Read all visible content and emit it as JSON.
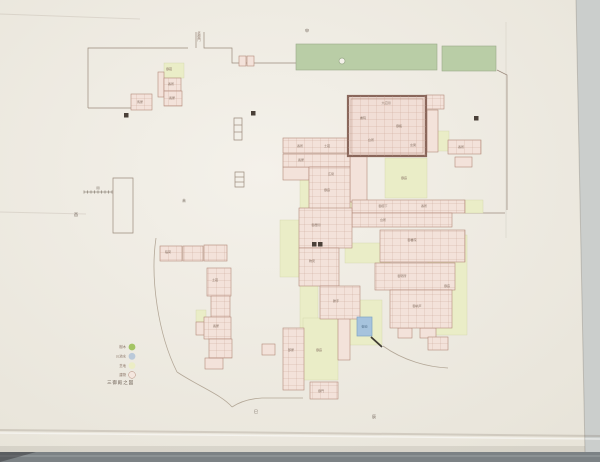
{
  "scene": {
    "table_color": "#b7babb",
    "table_right_color": "#cbcecc",
    "table_bottom_color": "#7c8285",
    "paper_light": "#f4f1ea",
    "paper_dark": "#e7e3d8"
  },
  "map": {
    "colors": {
      "ink": "#9b8a7c",
      "road": "#b3a797",
      "greenbelt": "#b9cda6",
      "greenbelt_stroke": "#99aa89",
      "courtyard": "#eaedc7",
      "courtyard_stroke": "#d2d5aa",
      "building_fill": "#f3e2da",
      "building_stroke": "#b28a7a",
      "room_line": "#c7a193",
      "main_fill": "#f1ded6",
      "main_stroke": "#8a675b",
      "water": "#a6c3dd",
      "water_stroke": "#7fa3c4",
      "gate_black": "#4a4038",
      "label_ink": "#8a7466",
      "mark_ink": "#6f6257"
    },
    "greenbelts": [
      [
        296,
        44,
        141,
        26
      ],
      [
        442,
        46,
        54,
        25
      ]
    ],
    "greenbelt_marker": {
      "cx": 342,
      "cy": 61,
      "r": 3
    },
    "courtyards": [
      [
        300,
        157,
        60,
        63
      ],
      [
        385,
        158,
        42,
        40
      ],
      [
        432,
        131,
        17,
        20
      ],
      [
        280,
        220,
        38,
        57
      ],
      [
        300,
        277,
        18,
        80
      ],
      [
        303,
        318,
        35,
        62
      ],
      [
        428,
        235,
        39,
        100
      ],
      [
        340,
        300,
        42,
        45
      ],
      [
        164,
        63,
        20,
        15
      ],
      [
        463,
        200,
        20,
        13
      ],
      [
        196,
        310,
        10,
        12
      ],
      [
        345,
        243,
        45,
        20
      ]
    ],
    "buildings_grid": [
      [
        164,
        78,
        17,
        13
      ],
      [
        164,
        91,
        18,
        15
      ],
      [
        131,
        94,
        21,
        16
      ],
      [
        426,
        95,
        18,
        14
      ],
      [
        448,
        140,
        33,
        14
      ],
      [
        283,
        138,
        67,
        15
      ],
      [
        283,
        154,
        67,
        13
      ],
      [
        309,
        167,
        41,
        43
      ],
      [
        352,
        200,
        113,
        13
      ],
      [
        352,
        213,
        100,
        14
      ],
      [
        299,
        208,
        53,
        40
      ],
      [
        299,
        248,
        40,
        38
      ],
      [
        320,
        286,
        40,
        33
      ],
      [
        380,
        230,
        85,
        32
      ],
      [
        375,
        263,
        80,
        27
      ],
      [
        390,
        290,
        62,
        38
      ],
      [
        428,
        337,
        20,
        13
      ],
      [
        283,
        328,
        21,
        62
      ],
      [
        310,
        382,
        28,
        17
      ],
      [
        160,
        246,
        22,
        15
      ],
      [
        183,
        246,
        20,
        15
      ],
      [
        204,
        245,
        23,
        16
      ],
      [
        207,
        268,
        24,
        28
      ],
      [
        211,
        296,
        19,
        21
      ],
      [
        204,
        317,
        27,
        22
      ],
      [
        209,
        339,
        23,
        19
      ]
    ],
    "buildings_plain": [
      [
        158,
        72,
        6,
        25
      ],
      [
        239,
        56,
        7,
        10
      ],
      [
        247,
        56,
        7,
        10
      ],
      [
        427,
        110,
        11,
        42
      ],
      [
        455,
        157,
        17,
        10
      ],
      [
        283,
        167,
        26,
        13
      ],
      [
        350,
        152,
        17,
        50
      ],
      [
        398,
        328,
        14,
        10
      ],
      [
        420,
        328,
        16,
        10
      ],
      [
        338,
        318,
        12,
        42
      ],
      [
        262,
        344,
        13,
        11
      ],
      [
        196,
        322,
        12,
        13
      ],
      [
        205,
        358,
        18,
        11
      ]
    ],
    "main_block": [
      348,
      96,
      78,
      60
    ],
    "pond": [
      357,
      317,
      15,
      19
    ],
    "pond_label": "御池",
    "gate_squares": [
      [
        124,
        113
      ],
      [
        251,
        111
      ],
      [
        474,
        116
      ],
      [
        312,
        242
      ],
      [
        318,
        242
      ]
    ],
    "walls": [
      "M88,108 V48 H188",
      "M196,48 V32",
      "M204,32 V48 H232 V63 H258",
      "M88,108 H133",
      "M258,63 H296",
      "M497,70 L507,75 V210",
      "M465,213 H505",
      "M113,178 h20 v55 h-20 z",
      "M234,118 h8 v22 h-8 z",
      "M234,125 h8",
      "M234,132 h8",
      "M235,172 h9 v15 h-9 z",
      "M235,177 h9",
      "M235,182 h9"
    ],
    "roads": [
      "M156,238 C150,278 158,334 177,372",
      "M177,372 C198,386 222,395 232,407",
      "M232,407 Q244,399 262,398 L303,398",
      "M383,346 C404,361 428,367 448,368"
    ],
    "bold_marks": [
      "M371,337 L382,347"
    ],
    "scale_bar": {
      "x1": 84,
      "x2": 112,
      "y": 192,
      "ticks": 8,
      "label": "間"
    },
    "gate_label": {
      "x": 199,
      "y": 34,
      "text": "北御門"
    },
    "section_marks": [
      [
        307,
        32,
        "申"
      ],
      [
        76,
        216,
        "酉"
      ],
      [
        184,
        202,
        "未"
      ],
      [
        256,
        413,
        "巳"
      ],
      [
        374,
        418,
        "辰"
      ]
    ],
    "labels": [
      [
        169,
        70,
        "御蔵"
      ],
      [
        171,
        85,
        "番所"
      ],
      [
        172,
        99,
        "長屋"
      ],
      [
        140,
        103,
        "馬屋"
      ],
      [
        386,
        104,
        "大広間"
      ],
      [
        363,
        119,
        "書院"
      ],
      [
        399,
        127,
        "御殿"
      ],
      [
        371,
        141,
        "台所"
      ],
      [
        413,
        146,
        "玄関"
      ],
      [
        300,
        147,
        "番所"
      ],
      [
        327,
        147,
        "土蔵"
      ],
      [
        301,
        161,
        "長屋"
      ],
      [
        331,
        175,
        "広間"
      ],
      [
        383,
        207,
        "御廊下"
      ],
      [
        424,
        207,
        "番所"
      ],
      [
        383,
        221,
        "台所"
      ],
      [
        316,
        226,
        "御居間"
      ],
      [
        312,
        262,
        "物見"
      ],
      [
        336,
        302,
        "勝手"
      ],
      [
        412,
        241,
        "御書院"
      ],
      [
        402,
        277,
        "御寝所"
      ],
      [
        417,
        307,
        "御納戸"
      ],
      [
        404,
        179,
        "御庭"
      ],
      [
        327,
        191,
        "御庭"
      ],
      [
        447,
        287,
        "御庭"
      ],
      [
        319,
        351,
        "御庭"
      ],
      [
        168,
        253,
        "稲荷"
      ],
      [
        215,
        281,
        "土蔵"
      ],
      [
        216,
        327,
        "長屋"
      ],
      [
        321,
        392,
        "御門"
      ],
      [
        291,
        351,
        "部屋"
      ],
      [
        461,
        148,
        "番所"
      ]
    ]
  },
  "legend": {
    "dot_x": 132,
    "rows": [
      {
        "label": "樹木",
        "color": "#a3c463",
        "outlined": false
      },
      {
        "label": "川池水",
        "color": "#bac9d9",
        "outlined": false
      },
      {
        "label": "芝地",
        "color": "#ecedc5",
        "outlined": false
      },
      {
        "label": "建物",
        "color": "#f4e7df",
        "outlined": true
      }
    ],
    "title": "三御殿之図"
  }
}
